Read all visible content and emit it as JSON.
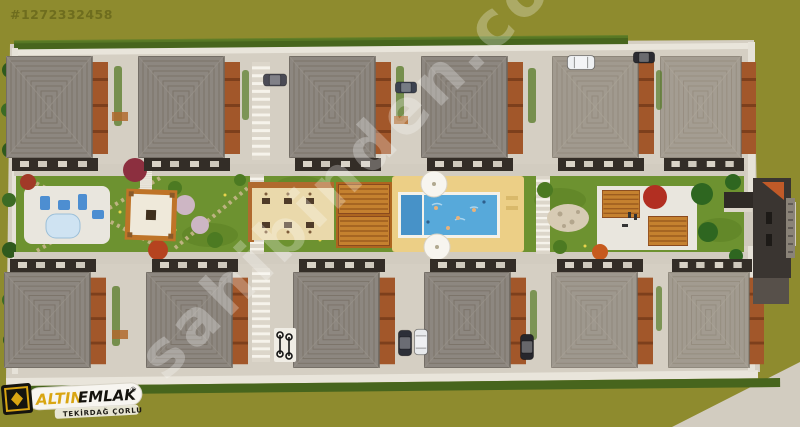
{
  "listing": {
    "id": "#1272332458"
  },
  "watermark": {
    "text": "sahibinden.com"
  },
  "logo": {
    "brand_gold": "ALTIN",
    "brand_dark": "EMLAK",
    "registered_mark": "®",
    "subtitle": "TEKİRDAĞ ÇORLU"
  },
  "scene": {
    "type": "aerial-3d-site-plan-render",
    "buildings": {
      "top_row_count": 6,
      "bottom_row_count": 6,
      "total": 12
    },
    "amenities": [
      "swimming-pool",
      "kids-pool-section",
      "pool-sun-deck",
      "wooden-deck-pergola",
      "outdoor-seating-terrace",
      "playground",
      "garden-paths",
      "pergola-bbq-area",
      "rock-garden",
      "parking-spots",
      "gatehouse"
    ],
    "vehicles": {
      "cars_visible": 7,
      "bicycle_rack": true
    },
    "colors": {
      "ground_olive": "#8e8b2e",
      "site_paving": "#d5cfc3",
      "roof_gray": "#8d8780",
      "roof_light": "#e8ddc6",
      "wood_accent": "#a2572a",
      "lawn_green": "#6d9230",
      "pool_blue": "#57a9da",
      "deck_sand": "#eccf86",
      "hedge_green": "#47651d",
      "brand_gold": "#d9a512"
    }
  }
}
